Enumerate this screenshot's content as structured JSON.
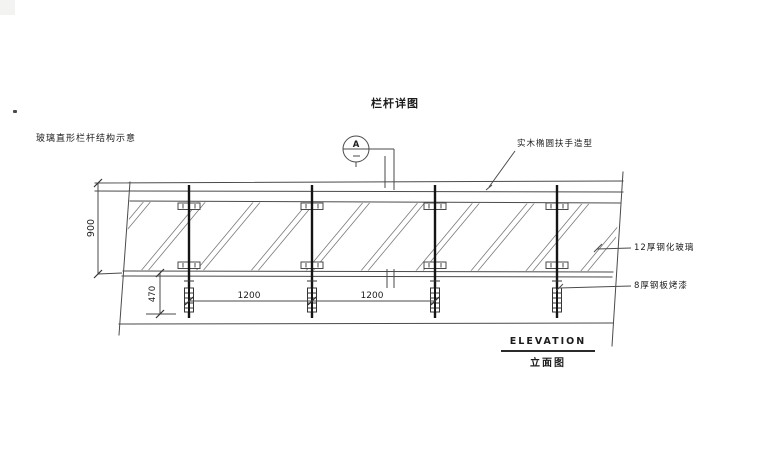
{
  "title": "栏杆详图",
  "drawing": {
    "left_note": "玻璃直形栏杆结构示意",
    "detail_marker": {
      "letter": "A"
    },
    "labels": {
      "handrail": "实木椭圆扶手造型",
      "glass": "12厚钢化玻璃",
      "steel_plate": "8厚钢板烤漆"
    },
    "dimensions": {
      "height": "900",
      "embed": "470",
      "bay1": "1200",
      "bay2": "1200"
    },
    "caption": {
      "en": "ELEVATION",
      "zh": "立面图"
    }
  },
  "colors": {
    "background": "#ffffff",
    "line": "#4a4a4a",
    "post": "#141414",
    "text": "#1c1c1c"
  }
}
